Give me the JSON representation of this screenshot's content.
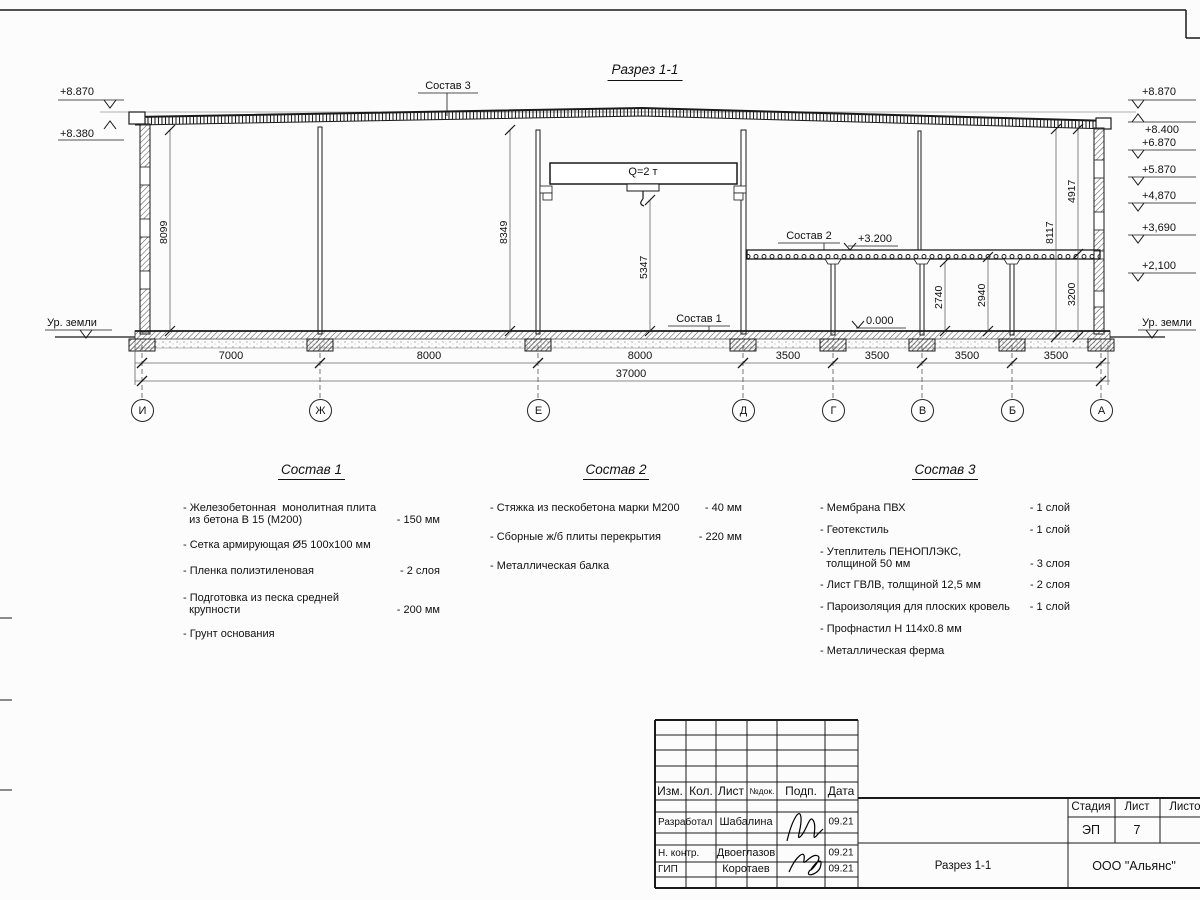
{
  "sheet": {
    "title": "Разрез 1-1"
  },
  "drawing": {
    "crane_label": "Q=2 т",
    "callout_sostav1": "Состав 1",
    "callout_sostav2": "Состав 2",
    "callout_sostav3": "Состав 3",
    "level_floor": "+3.200",
    "level_zero": "0.000",
    "ground_left": "Ур. земли",
    "ground_right": "Ур. земли",
    "elev_left": [
      "+8.870",
      "+8.380"
    ],
    "elev_right": [
      "+8.870",
      "+8.400",
      "+6.870",
      "+5.870",
      "+4,870",
      "+3,690",
      "+2,100"
    ],
    "vdims": {
      "v8099": "8099",
      "v8349": "8349",
      "v5347": "5347",
      "v8117": "8117",
      "v4917": "4917",
      "v3200": "3200",
      "v2740": "2740",
      "v2940": "2940"
    },
    "bottom_dims": [
      "7000",
      "8000",
      "8000",
      "3500",
      "3500",
      "3500",
      "3500"
    ],
    "total_dim": "37000",
    "axes": [
      "И",
      "Ж",
      "Е",
      "Д",
      "Г",
      "В",
      "Б",
      "А"
    ]
  },
  "lists": [
    {
      "title": "Состав 1",
      "items": [
        {
          "label": "- Железобетонная  монолитная плита\n  из бетона В 15 (М200)",
          "value": "- 150 мм"
        },
        {
          "label": "- Сетка армирующая Ø5 100х100 мм",
          "value": ""
        },
        {
          "label": "- Пленка полиэтиленовая",
          "value": "-  2 слоя"
        },
        {
          "label": "- Подготовка из песка средней\n  крупности",
          "value": "- 200 мм"
        },
        {
          "label": "- Грунт основания",
          "value": ""
        }
      ]
    },
    {
      "title": "Состав 2",
      "items": [
        {
          "label": "- Стяжка из пескобетона марки М200",
          "value": "- 40 мм"
        },
        {
          "label": "- Сборные ж/б плиты перекрытия",
          "value": "- 220 мм"
        },
        {
          "label": "- Металлическая балка",
          "value": ""
        }
      ]
    },
    {
      "title": "Состав 3",
      "items": [
        {
          "label": "- Мембрана ПВХ",
          "value": "- 1 слой"
        },
        {
          "label": "- Геотекстиль",
          "value": "- 1 слой"
        },
        {
          "label": "- Утеплитель ПЕНОПЛЭКС,\n  толщиной 50 мм",
          "value": "- 3 слоя"
        },
        {
          "label": "- Лист ГВЛВ, толщиной 12,5 мм",
          "value": "- 2 слоя"
        },
        {
          "label": "- Пароизоляция для плоских кровель",
          "value": "- 1 слой"
        },
        {
          "label": "- Профнастил Н 114х0.8 мм",
          "value": ""
        },
        {
          "label": "- Металлическая ферма",
          "value": ""
        }
      ]
    }
  ],
  "titleblock": {
    "headers": [
      "Изм.",
      "Кол.",
      "Лист",
      "№док.",
      "Подп.",
      "Дата"
    ],
    "rows": [
      {
        "role": "Разработал",
        "name": "Шабалина",
        "date": "09.21"
      },
      {
        "role": "Н. контр.",
        "name": "Двоеглазов",
        "date": "09.21"
      },
      {
        "role": "ГИП",
        "name": "Коротаев",
        "date": "09.21"
      }
    ],
    "stage_label": "Стадия",
    "sheet_label": "Лист",
    "sheets_label": "Листов",
    "stage": "ЭП",
    "sheet_no": "7",
    "sheets_total": "",
    "doc_title": "Разрез 1-1",
    "company": "ООО \"Альянс\""
  }
}
